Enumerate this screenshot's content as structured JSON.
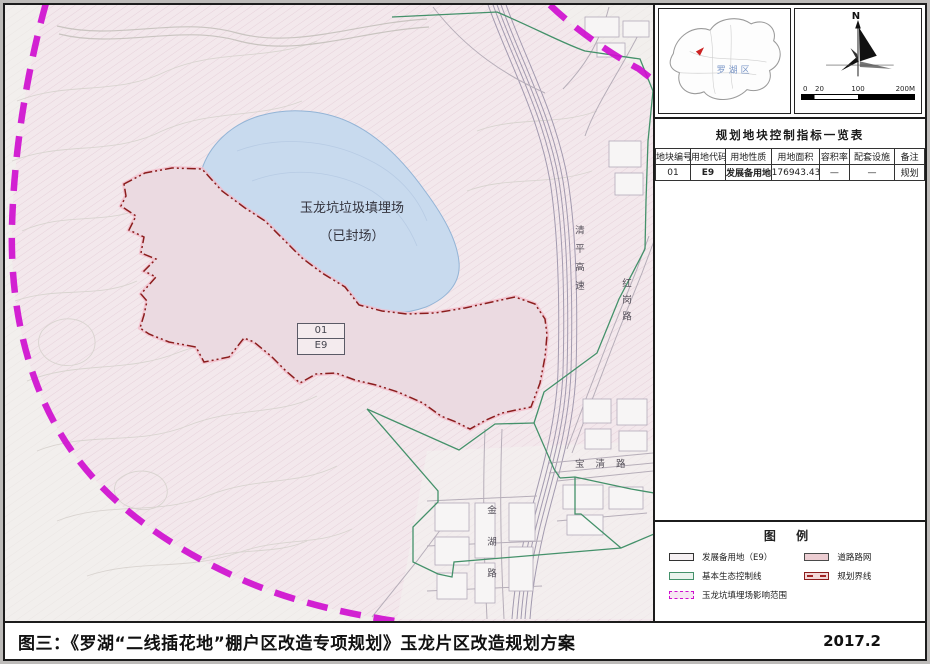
{
  "map": {
    "landfill_label": {
      "line1": "玉龙坑垃圾填埋场",
      "line2": "（已封场）"
    },
    "parcel_tag": {
      "code": "01",
      "use_code": "E9"
    },
    "roads": {
      "qingping": "清平高速",
      "honggang": "红岗路",
      "baoqing": "宝清路",
      "jinhu": "金湖路"
    },
    "colors": {
      "influence_boundary_magenta": "#cf0fcf",
      "eco_control_green": "#44916a",
      "planning_boundary_red": "#8b1d1d",
      "lake_blue": "#c8daee",
      "parcel_pink": "#ebdae1"
    }
  },
  "panel": {
    "locator": {
      "district": "罗湖区"
    },
    "north": {
      "label": "N",
      "scale": {
        "tick0": "0",
        "tick1": "20",
        "tick2": "100",
        "tick3": "200M"
      }
    },
    "table": {
      "title": "规划地块控制指标一览表",
      "headers": [
        "地块编号",
        "用地代码",
        "用地性质",
        "用地面积",
        "容积率",
        "配套设施",
        "备注"
      ],
      "rows": [
        [
          "01",
          "E9",
          "发展备用地",
          "176943.43",
          "—",
          "—",
          "规划"
        ]
      ]
    },
    "legend": {
      "title": "图 例",
      "items_left": [
        {
          "label": "发展备用地（E9）"
        },
        {
          "label": "基本生态控制线"
        },
        {
          "label": "玉龙坑填埋场影响范围"
        }
      ],
      "items_right": [
        {
          "label": "道路路网"
        },
        {
          "label": "规划界线"
        }
      ]
    }
  },
  "footer": {
    "caption": "图三：《罗湖“二线插花地”棚户区改造专项规划》玉龙片区改造规划方案",
    "date": "2017.2"
  }
}
